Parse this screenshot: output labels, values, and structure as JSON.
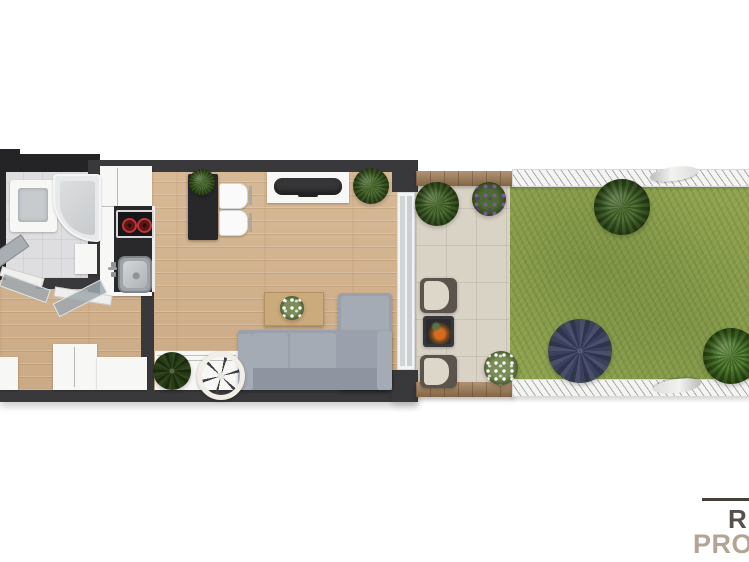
{
  "scene": {
    "description": "3D top-down floor plan render of a studio apartment with terrace and garden",
    "rooms": [
      "bathroom",
      "kitchen",
      "hallway",
      "living-room",
      "terrace",
      "garden"
    ]
  },
  "watermark": {
    "initial": "R",
    "prefix": "PRO"
  },
  "palette": {
    "wall": "#39393b",
    "wall_dark": "#242426",
    "wood_floor": "#d4b48e",
    "bathroom_tile": "#dedee1",
    "terrace_tile": "#d9d3c6",
    "lawn": "#8ea24f",
    "sofa": "#9ba1ac",
    "counter": "#29292b",
    "wood_trim": "#a07c55",
    "logo_initial": "#57504c",
    "logo_prefix": "#b4a493",
    "logo_line": "#45403b",
    "background": "#ffffff"
  }
}
